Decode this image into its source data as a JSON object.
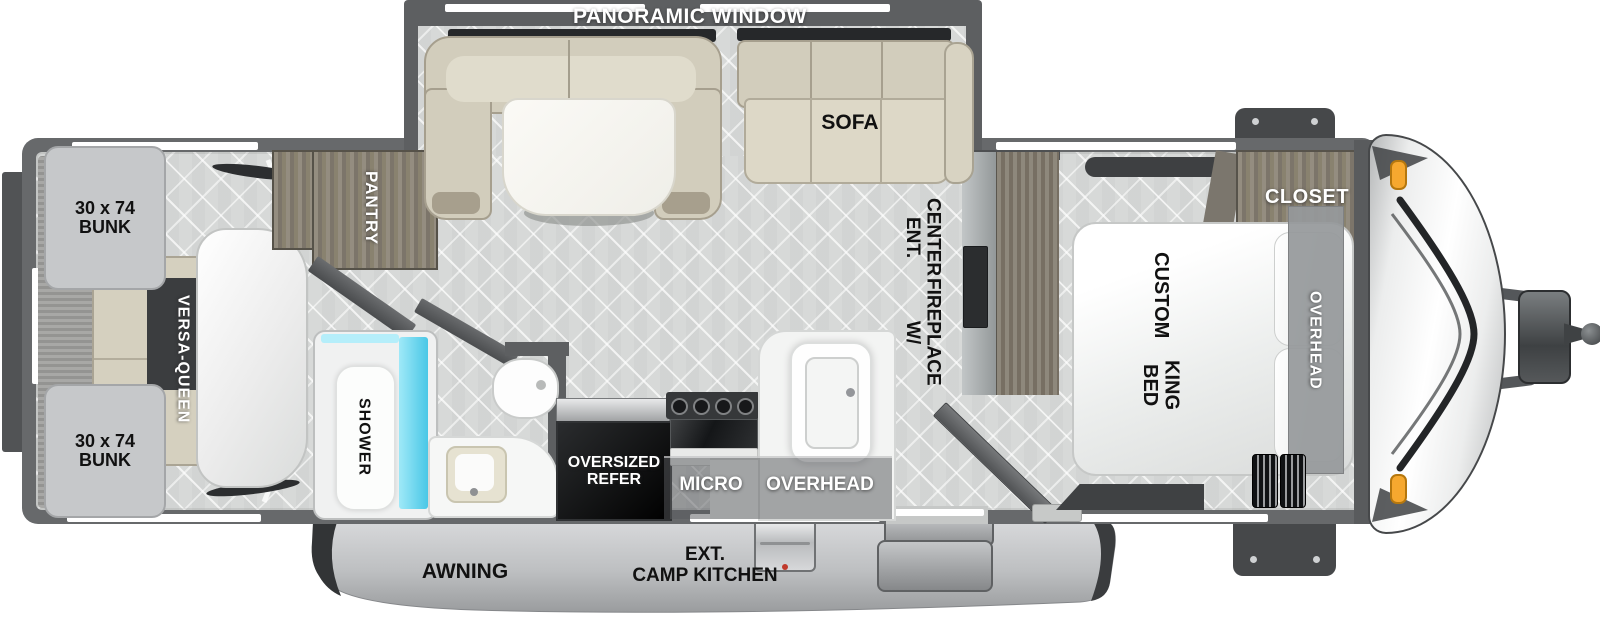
{
  "labels": {
    "panoramic_window": "PANORAMIC WINDOW",
    "sofa": "SOFA",
    "pantry": "PANTRY",
    "shower": "SHOWER",
    "versa_queen": "VERSA-QUEEN",
    "bunk_top": {
      "line1": "30 x 74",
      "line2": "BUNK"
    },
    "bunk_bottom": {
      "line1": "30 x 74",
      "line2": "BUNK"
    },
    "ent_center": {
      "line1": "ENT. CENTER",
      "line2": "W/ FIREPLACE"
    },
    "king_bed": {
      "line1": "CUSTOM",
      "line2": "KING BED"
    },
    "closet": "CLOSET",
    "overhead_bedroom": "OVERHEAD",
    "refer": {
      "line1": "OVERSIZED",
      "line2": "REFER"
    },
    "micro": "MICRO",
    "overhead_kitchen": "OVERHEAD",
    "awning": "AWNING",
    "camp_kitchen": {
      "line1": "EXT.",
      "line2": "CAMP KITCHEN"
    }
  },
  "colors": {
    "wall": "#67696b",
    "floor": "#d9dbda",
    "cushion_beige": "#d2cdbc",
    "shower_glass": "#49c7e6",
    "marker_light": "#f6a82f",
    "refer_black": "#0a0b0c",
    "awning_gray": "#b8babc"
  }
}
